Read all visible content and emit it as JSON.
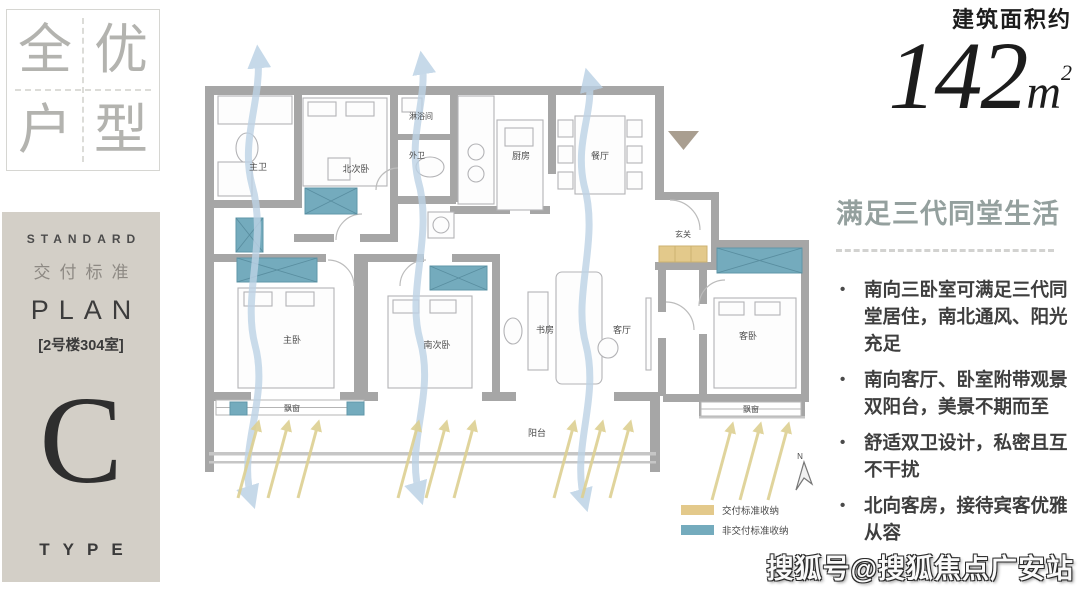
{
  "badge": {
    "char_1": "全",
    "char_2": "优",
    "char_3": "户",
    "char_4": "型"
  },
  "sidebar": {
    "standard_en": "STANDARD",
    "standard_cn": "交付标准",
    "plan_en": "PLAN",
    "unit_no": "[2号楼304室]",
    "type_letter": "C",
    "type_en": "TYPE"
  },
  "area": {
    "label": "建筑面积约",
    "number": "142",
    "unit_base": "m",
    "unit_sup": "2"
  },
  "selling_points": {
    "heading": "满足三代同堂生活",
    "bullets": [
      "南向三卧室可满足三代同堂居住，南北通风、阳光充足",
      "南向客厅、卧室附带观景双阳台，美景不期而至",
      "舒适双卫设计，私密且互不干扰",
      "北向客房，接待宾客优雅从容"
    ]
  },
  "floorplan": {
    "rooms": {
      "master_bath": "主卫",
      "north_bedroom": "北次卧",
      "shower_room": "淋浴间",
      "guest_bath": "外卫",
      "kitchen": "厨房",
      "dining": "餐厅",
      "foyer": "玄关",
      "master_bedroom": "主卧",
      "south_bedroom": "南次卧",
      "study": "书房",
      "living": "客厅",
      "guest_bedroom": "客卧",
      "balcony": "阳台",
      "bay_window_1": "飘窗",
      "bay_window_2": "飘窗"
    },
    "legend": {
      "standard_label": "交付标准收纳",
      "standard_color": "#e3c98b",
      "non_standard_label": "非交付标准收纳",
      "non_standard_color": "#74abbd"
    },
    "compass_letter": "N"
  },
  "watermark": "搜狐号@搜狐焦点广安站",
  "colors": {
    "accent_teal": "#74abbd",
    "accent_tan": "#e3c98b",
    "heading_teal_gray": "#94a09e",
    "wall_gray": "#a6a6a6"
  }
}
